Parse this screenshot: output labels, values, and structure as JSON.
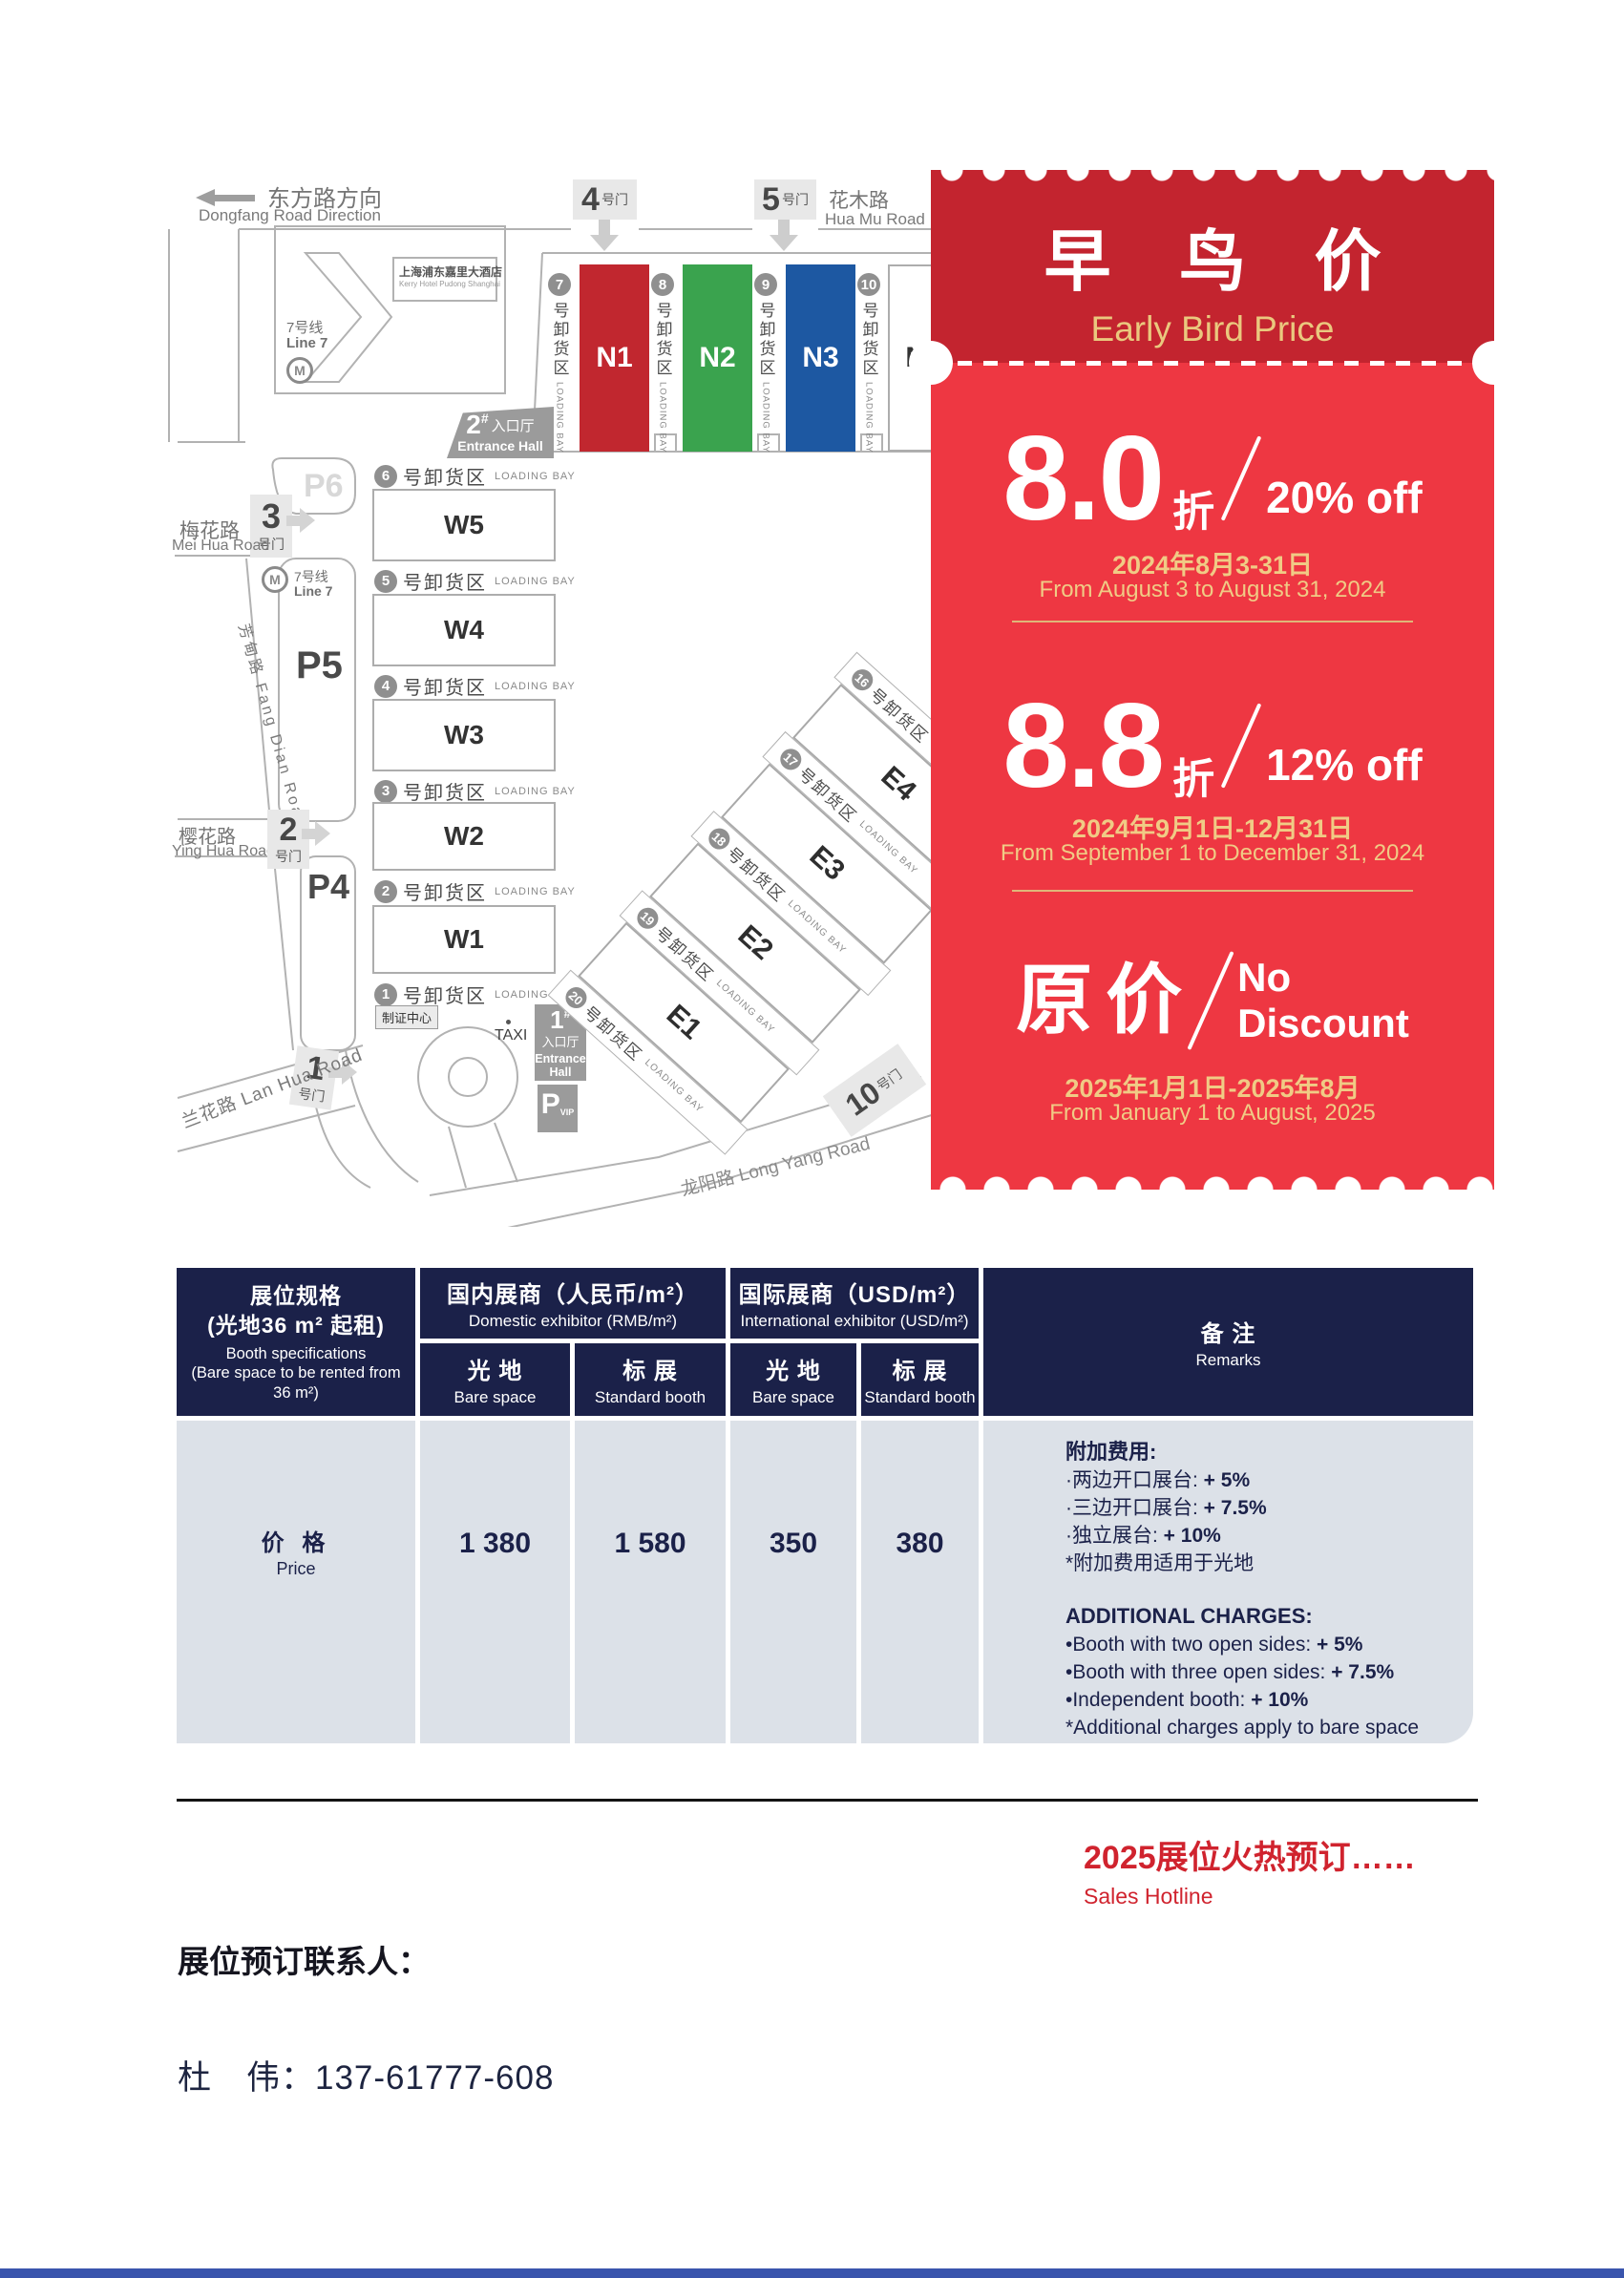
{
  "map": {
    "direction": {
      "cn": "东方路方向",
      "en": "Dongfang Road Direction"
    },
    "roads": {
      "huamu_cn": "花木路",
      "huamu_en": "Hua Mu Road",
      "meihua_cn": "梅花路",
      "meihua_en": "Mei Hua Road",
      "fangdian": "芳甸路 Fang Dian Road",
      "yinghua_cn": "樱花路",
      "yinghua_en": "Ying Hua Road",
      "lanhua": "兰花路 Lan Hua Road",
      "longyang": "龙阳路 Long Yang Road"
    },
    "gates": {
      "suffix": "号门",
      "n1": "1",
      "n2": "2",
      "n3": "3",
      "n4": "4",
      "n5": "5",
      "n10": "10"
    },
    "hotel": {
      "cn": "上海浦东嘉里大酒店",
      "en": "Kerry Hotel Pudong Shanghai"
    },
    "line7": {
      "cn": "7号线",
      "en": "Line 7",
      "m": "M"
    },
    "halls": {
      "n": [
        "N1",
        "N2",
        "N3",
        "N4"
      ],
      "w": [
        "W5",
        "W4",
        "W3",
        "W2",
        "W1"
      ],
      "e": [
        "E4",
        "E3",
        "E2",
        "E1"
      ]
    },
    "bays": {
      "suffix": "号卸货区",
      "loading": "LOADING BAY",
      "n": [
        "7",
        "8",
        "9",
        "10"
      ],
      "w": [
        "6",
        "5",
        "4",
        "3",
        "2",
        "1"
      ],
      "e": [
        "16",
        "17",
        "18",
        "19",
        "20"
      ]
    },
    "entrance2": {
      "num": "2",
      "hash": "#",
      "cn": "入口厅",
      "en": "Entrance Hall"
    },
    "entrance1": {
      "num": "1",
      "hash": "#",
      "cn": "入口厅",
      "en_a": "Entrance",
      "en_b": "Hall"
    },
    "parking": {
      "p6": "P6",
      "p5": "P5",
      "p4": "P4",
      "p": "P",
      "vip": "VIP"
    },
    "taxi": "TAXI",
    "badge_center": "制证中心"
  },
  "ticket": {
    "title_cn": "早 鸟 价",
    "title_en": "Early Bird Price",
    "tiers": [
      {
        "value": "8.0",
        "unit": "折",
        "pct": "20% off",
        "date_cn": "2024年8月3-31日",
        "date_en": "From August 3 to August 31, 2024"
      },
      {
        "value": "8.8",
        "unit": "折",
        "pct": "12% off",
        "date_cn": "2024年9月1日-12月31日",
        "date_en": "From September 1 to December 31, 2024"
      },
      {
        "value": "原价",
        "line1": "No",
        "line2": "Discount",
        "date_cn": "2025年1月1日-2025年8月",
        "date_en": "From January 1 to August, 2025"
      }
    ]
  },
  "table": {
    "col1": {
      "cn1": "展位规格",
      "cn2": "(光地36 m² 起租)",
      "en1": "Booth specifications",
      "en2": "(Bare space to be rented from 36 m²)"
    },
    "domestic": {
      "cn": "国内展商（人民币/m²）",
      "en": "Domestic exhibitor (RMB/m²)"
    },
    "international": {
      "cn": "国际展商（USD/m²）",
      "en": "International exhibitor (USD/m²)"
    },
    "remarks_header": {
      "cn": "备 注",
      "en": "Remarks"
    },
    "sub": {
      "bare_cn": "光 地",
      "bare_en": "Bare space",
      "std_cn": "标 展",
      "std_en": "Standard booth"
    },
    "price_row": {
      "label_cn": "价 格",
      "label_en": "Price",
      "values": [
        "1 380",
        "1 580",
        "350",
        "380"
      ]
    },
    "remarks_body": {
      "cn_title": "附加费用:",
      "cn": [
        {
          "text": "·两边开口展台: ",
          "value": "+ 5%"
        },
        {
          "text": "·三边开口展台: ",
          "value": "+ 7.5%"
        },
        {
          "text": "·独立展台: ",
          "value": "+ 10%"
        },
        {
          "text": "*附加费用适用于光地",
          "value": ""
        }
      ],
      "en_title": "ADDITIONAL CHARGES:",
      "en": [
        {
          "text": "•Booth with two open sides: ",
          "value": "+ 5%"
        },
        {
          "text": "•Booth with three open sides: ",
          "value": "+ 7.5%"
        },
        {
          "text": "•Independent booth: ",
          "value": "+ 10%"
        },
        {
          "text": "*Additional charges apply to bare space",
          "value": ""
        }
      ]
    }
  },
  "footer": {
    "hotline_cn": "2025展位火热预订……",
    "hotline_en": "Sales Hotline",
    "contact_label": "展位预订联系人：",
    "contact": "杜　伟：137-61777-608"
  }
}
